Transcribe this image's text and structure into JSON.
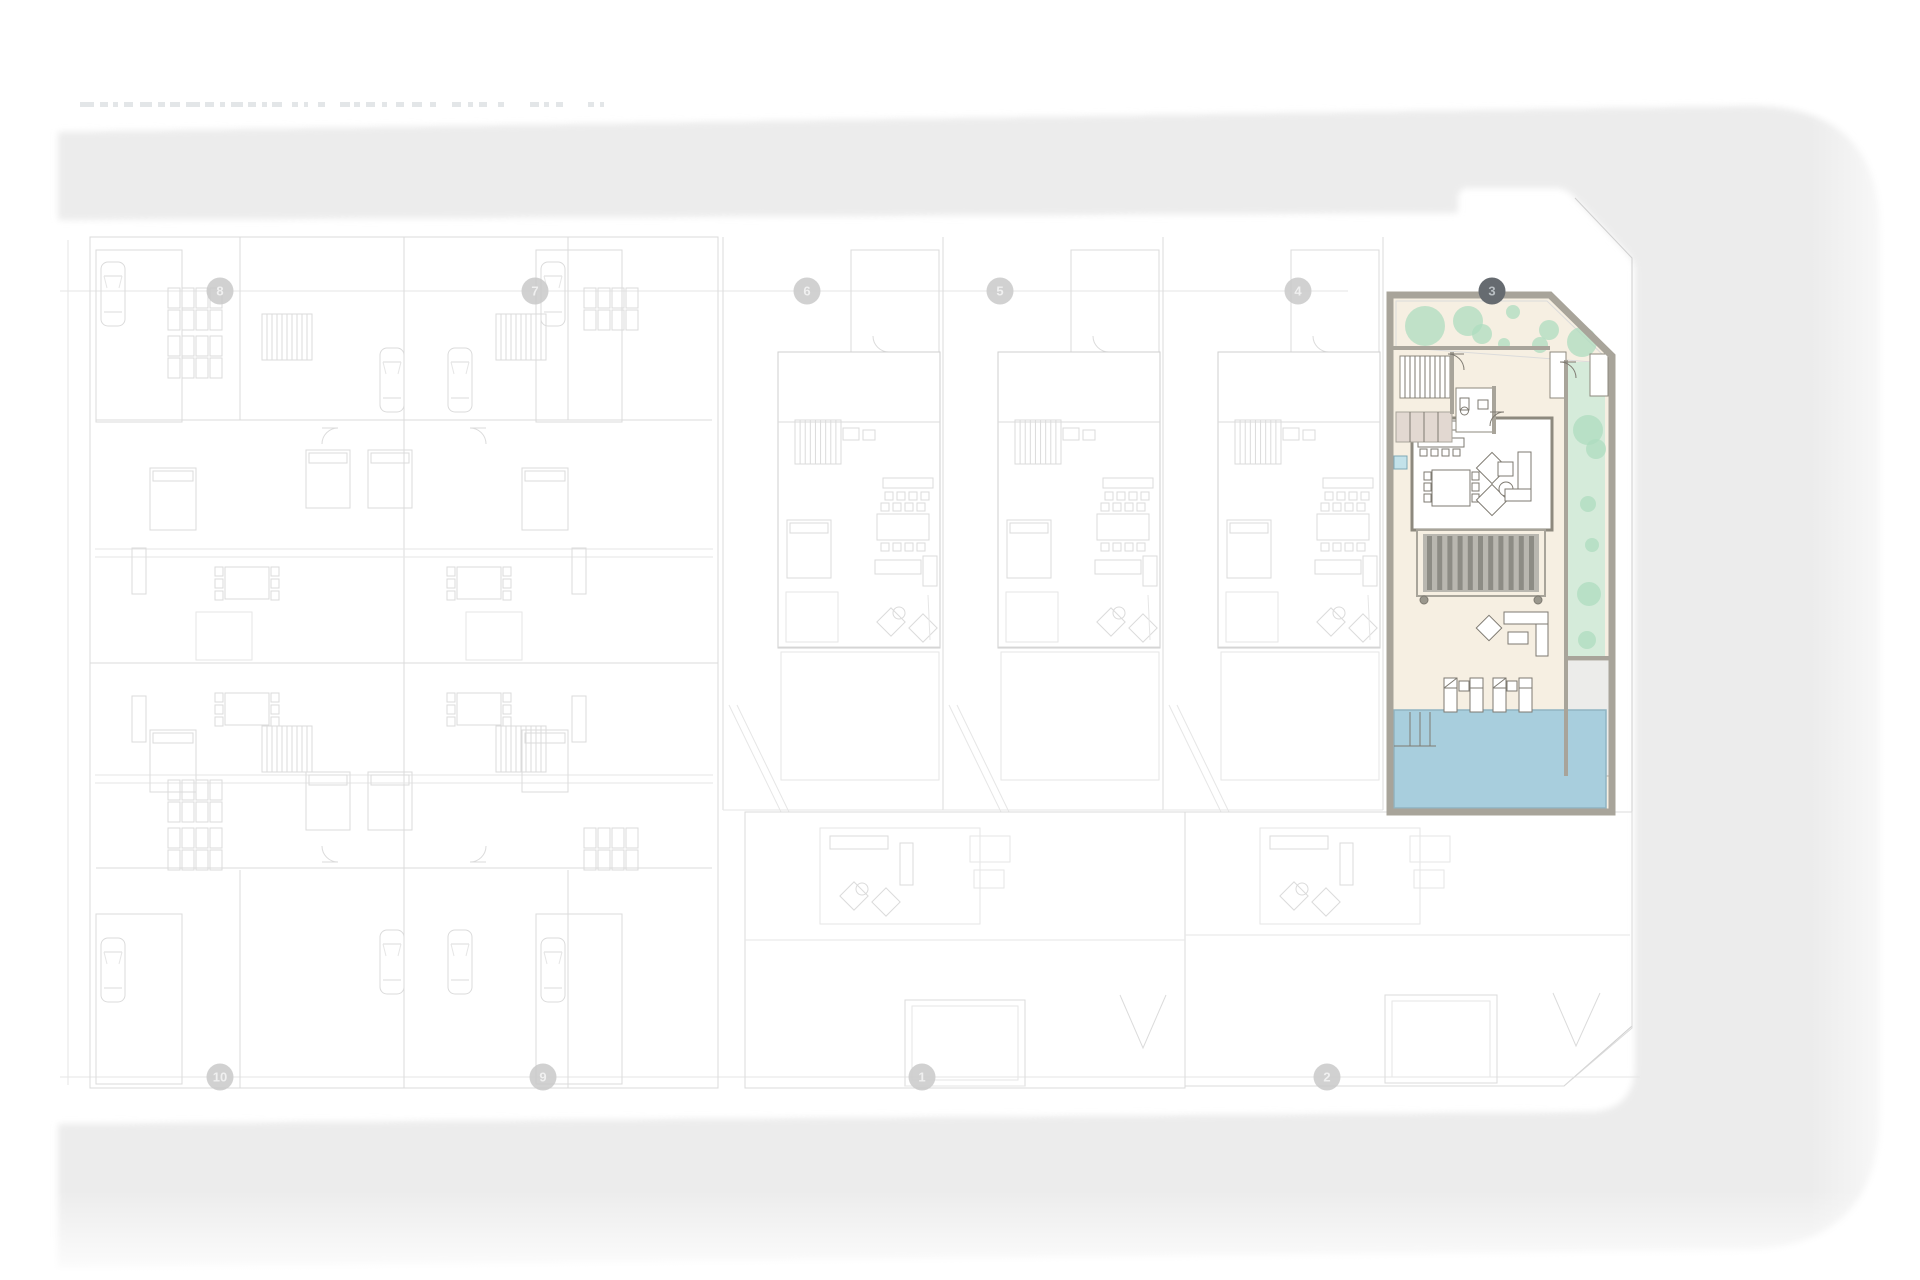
{
  "page": {
    "kind": "architectural-site-plan",
    "colors": {
      "street_band": "#ececec",
      "faint_line": "#dbdbdb",
      "marker_light_fill": "#c9c9c9",
      "marker_light_text": "#f0f0f0",
      "marker_dark_fill": "#666b70",
      "marker_dark_text": "#b9bfc3",
      "unit_wall": "#a8a49a",
      "unit_floor_cream": "#f6efe2",
      "garden_green": "#d5ebda",
      "garden_blob": "#aedcbf",
      "pool_blue": "#a8cedd",
      "pool_edge": "#8fb4c2",
      "deck_bg": "#b9b7b0",
      "deck_slat": "#8d8c85",
      "closet_mauve": "#e2d8d1",
      "pad_gray": "#ececE8"
    },
    "title_fragment_dashes": [
      [
        80,
        14
      ],
      [
        100,
        8
      ],
      [
        113,
        5
      ],
      [
        124,
        9
      ],
      [
        140,
        12
      ],
      [
        158,
        7
      ],
      [
        170,
        10
      ],
      [
        186,
        14
      ],
      [
        205,
        9
      ],
      [
        220,
        5
      ],
      [
        231,
        12
      ],
      [
        248,
        8
      ],
      [
        262,
        5
      ],
      [
        272,
        10
      ],
      [
        292,
        6
      ],
      [
        304,
        4
      ],
      [
        318,
        7
      ],
      [
        340,
        10
      ],
      [
        354,
        6
      ],
      [
        366,
        9
      ],
      [
        382,
        5
      ],
      [
        396,
        8
      ],
      [
        412,
        10
      ],
      [
        430,
        6
      ],
      [
        452,
        9
      ],
      [
        468,
        5
      ],
      [
        479,
        8
      ],
      [
        498,
        6
      ],
      [
        530,
        9
      ],
      [
        544,
        5
      ],
      [
        556,
        7
      ],
      [
        588,
        6
      ],
      [
        600,
        4
      ]
    ]
  },
  "band": {
    "fill": "#ececec",
    "outer": "M58,132 L1745,106 Q1880,103 1880,232 L1880,1112 Q1880,1246 1746,1250 L58,1268 Z",
    "inner": "M58,220 L1458,213 L1458,199 Q1458,188 1469,188 L1554,188 Q1566,188 1574,197 L1628,254 Q1635,262 1635,272 L1635,1064 Q1635,1111 1588,1112 L58,1124 Z"
  },
  "markers": {
    "y_top": 291,
    "y_bottom": 1077,
    "radius": 13.5,
    "top": [
      {
        "label": "8",
        "x": 220
      },
      {
        "label": "7",
        "x": 535
      },
      {
        "label": "6",
        "x": 807
      },
      {
        "label": "5",
        "x": 1000
      },
      {
        "label": "4",
        "x": 1298
      },
      {
        "label": "3",
        "x": 1492,
        "dark": true
      }
    ],
    "bottom": [
      {
        "label": "10",
        "x": 220
      },
      {
        "label": "9",
        "x": 543
      },
      {
        "label": "1",
        "x": 922
      },
      {
        "label": "2",
        "x": 1327
      }
    ]
  },
  "background": {
    "boundary": [
      [
        1575,
        198
      ],
      [
        1632,
        258
      ],
      [
        1632,
        1026
      ],
      [
        1564,
        1086
      ]
    ],
    "grid_lines": [
      [
        60,
        291,
        1348,
        291
      ],
      [
        60,
        1077,
        1640,
        1077
      ],
      [
        68,
        240,
        68,
        1085
      ]
    ],
    "left_block": {
      "outer": [
        90,
        237,
        628,
        851
      ],
      "lines": [
        [
          404,
          237,
          404,
          1088
        ],
        [
          90,
          663,
          718,
          663
        ],
        [
          95,
          549,
          713,
          549
        ],
        [
          95,
          557,
          713,
          557
        ],
        [
          95,
          775,
          713,
          775
        ],
        [
          95,
          783,
          713,
          783
        ],
        [
          96,
          420,
          404,
          420
        ],
        [
          404,
          420,
          712,
          420
        ],
        [
          96,
          868,
          404,
          868
        ],
        [
          404,
          868,
          712,
          868
        ],
        [
          240,
          237,
          240,
          420
        ],
        [
          568,
          237,
          568,
          420
        ],
        [
          240,
          870,
          240,
          1088
        ],
        [
          568,
          870,
          568,
          1088
        ]
      ],
      "garages": [
        [
          96,
          250,
          86,
          172
        ],
        [
          536,
          250,
          86,
          172
        ],
        [
          96,
          914,
          86,
          170
        ],
        [
          536,
          914,
          86,
          170
        ]
      ],
      "cars": [
        [
          101,
          262
        ],
        [
          101,
          938
        ],
        [
          541,
          262
        ],
        [
          541,
          938
        ],
        [
          380,
          348
        ],
        [
          448,
          348
        ],
        [
          380,
          930
        ],
        [
          448,
          930
        ]
      ],
      "shelves": [
        [
          168,
          288
        ],
        [
          168,
          336
        ],
        [
          168,
          780
        ],
        [
          168,
          828
        ],
        [
          584,
          288
        ],
        [
          584,
          828
        ]
      ],
      "stairs": [
        [
          262,
          314
        ],
        [
          496,
          314
        ],
        [
          262,
          726
        ],
        [
          496,
          726
        ]
      ],
      "beds": [
        [
          150,
          468,
          46,
          62
        ],
        [
          306,
          450,
          44,
          58
        ],
        [
          522,
          468,
          46,
          62
        ],
        [
          368,
          450,
          44,
          58
        ],
        [
          150,
          730,
          46,
          62
        ],
        [
          306,
          772,
          44,
          58
        ],
        [
          522,
          730,
          46,
          62
        ],
        [
          368,
          772,
          44,
          58
        ]
      ],
      "tables": [
        [
          247,
          583
        ],
        [
          479,
          583
        ],
        [
          247,
          709
        ],
        [
          479,
          709
        ]
      ],
      "patios": [
        [
          196,
          612,
          56,
          48
        ],
        [
          466,
          612,
          56,
          48
        ]
      ],
      "sofas": [
        [
          132,
          548,
          14,
          46
        ],
        [
          572,
          548,
          14,
          46
        ],
        [
          132,
          696,
          14,
          46
        ],
        [
          572,
          696,
          14,
          46
        ]
      ],
      "arcs": [
        [
          322,
          428,
          16,
          0
        ],
        [
          486,
          428,
          16,
          1
        ],
        [
          322,
          862,
          16,
          3
        ],
        [
          486,
          862,
          16,
          2
        ]
      ]
    },
    "mid_villas": {
      "x0": [
        723,
        943,
        1163
      ],
      "divider_x": 1383,
      "top": 237,
      "bottom": 810
    },
    "bottom_villas": {
      "villa1_rect": [
        745,
        812,
        440,
        276
      ],
      "villa2_poly": [
        [
          1185,
          812
        ],
        [
          1632,
          812
        ],
        [
          1632,
          1028
        ],
        [
          1564,
          1086
        ],
        [
          1185,
          1086
        ]
      ],
      "cluster_x0": [
        760,
        1200
      ],
      "garages": [
        [
          905,
          1000,
          120,
          86
        ],
        [
          1385,
          995,
          112,
          88
        ]
      ],
      "vees": [
        [
          1120,
          995,
          1143,
          1048,
          1166,
          995
        ],
        [
          1553,
          993,
          1576,
          1046,
          1600,
          993
        ]
      ],
      "lines": [
        [
          745,
          940,
          1185,
          940
        ],
        [
          1185,
          935,
          1630,
          935
        ],
        [
          905,
          1086,
          1025,
          1086
        ]
      ]
    }
  },
  "unit": {
    "outline": "M1390,295 L1550,295 L1612,356 L1612,812 L1390,812 Z",
    "floor_fill": "#f6efe2",
    "top_garden": [
      [
        1396,
        301
      ],
      [
        1547,
        301
      ],
      [
        1605,
        357
      ],
      [
        1605,
        363
      ],
      [
        1396,
        347
      ]
    ],
    "top_blobs": [
      [
        1425,
        326,
        20
      ],
      [
        1468,
        321,
        15
      ],
      [
        1482,
        334,
        10
      ],
      [
        1513,
        312,
        7
      ],
      [
        1549,
        330,
        10
      ],
      [
        1582,
        342,
        15
      ],
      [
        1540,
        345,
        8
      ],
      [
        1504,
        344,
        6
      ]
    ],
    "right_garden": [
      1568,
      362,
      37,
      296
    ],
    "right_blobs": [
      [
        1588,
        430,
        15
      ],
      [
        1596,
        449,
        10
      ],
      [
        1588,
        504,
        8
      ],
      [
        1592,
        545,
        7
      ],
      [
        1589,
        594,
        12
      ],
      [
        1587,
        640,
        9
      ]
    ],
    "pad": [
      1566,
      660,
      46,
      116
    ],
    "pool": [
      1394,
      710,
      212,
      98
    ],
    "pool_steps_x": [
      1410,
      1420,
      1430
    ],
    "pool_steps_y": [
      712,
      746
    ],
    "living_room": [
      1412,
      418,
      140,
      112
    ],
    "kitchen_counter": [
      1416,
      421,
      58,
      9
    ],
    "kitchen_island": [
      1418,
      438,
      46,
      9
    ],
    "stool_y": 449,
    "stool_x0": 1420,
    "stool_n": 4,
    "dining_table": [
      1432,
      470,
      38,
      36
    ],
    "rot_chairs": [
      [
        1492,
        468
      ],
      [
        1492,
        500
      ]
    ],
    "round_table": [
      1506,
      489,
      7
    ],
    "sq_table": [
      1498,
      462,
      15,
      14
    ],
    "sofa_rects": [
      [
        1518,
        452,
        13,
        48
      ],
      [
        1505,
        489,
        26,
        12
      ]
    ],
    "deck_frame": [
      1417,
      530,
      128,
      66
    ],
    "deck_inner": [
      1423,
      534,
      116,
      58
    ],
    "deck_cols": [
      [
        1424,
        600
      ],
      [
        1538,
        600
      ]
    ],
    "blue_square": [
      1394,
      456,
      13,
      13
    ],
    "entry_stairs": [
      1400,
      356,
      50,
      42
    ],
    "mauve_closet": [
      1396,
      412,
      56,
      30
    ],
    "bath": [
      1456,
      388,
      38,
      44
    ],
    "toilet": [
      1460,
      398,
      9,
      12
    ],
    "sink": [
      1478,
      400,
      10,
      9
    ],
    "closets": [
      [
        1550,
        352,
        16,
        46
      ],
      [
        1590,
        354,
        18,
        42
      ]
    ],
    "inner_walls": [
      [
        1393,
        348,
        1550,
        348
      ],
      [
        1566,
        360,
        1566,
        776
      ],
      [
        1566,
        658,
        1612,
        658
      ],
      [
        1452,
        352,
        1452,
        414
      ],
      [
        1494,
        386,
        1494,
        434
      ]
    ],
    "door_arcs": [
      [
        1464,
        354,
        16,
        1
      ],
      [
        1576,
        362,
        16,
        1
      ],
      [
        1490,
        412,
        14,
        0
      ]
    ],
    "out_sofa": [
      [
        1504,
        612,
        44,
        12
      ],
      [
        1536,
        624,
        12,
        32
      ],
      [
        1508,
        632,
        20,
        12
      ]
    ],
    "out_rot_chair": [
      1489,
      628
    ],
    "loungers_y": 678,
    "lounger_h": 34,
    "lounger_w": 13,
    "loungers_x": [
      1444,
      1470,
      1493,
      1519
    ],
    "lounger_tables": [
      [
        1459,
        681
      ],
      [
        1507,
        681
      ]
    ]
  }
}
